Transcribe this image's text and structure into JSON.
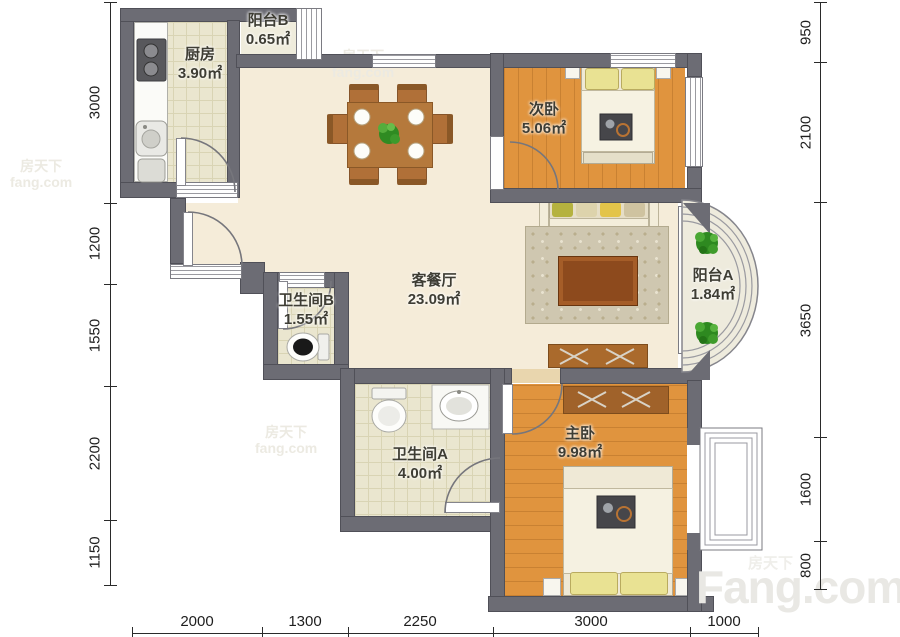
{
  "rooms": [
    {
      "id": "kitchen",
      "name": "厨房",
      "area": "3.90㎡"
    },
    {
      "id": "balcony-b",
      "name": "阳台B",
      "area": "0.65㎡"
    },
    {
      "id": "living-dining",
      "name": "客餐厅",
      "area": "23.09㎡"
    },
    {
      "id": "bedroom-second",
      "name": "次卧",
      "area": "5.06㎡"
    },
    {
      "id": "balcony-a",
      "name": "阳台A",
      "area": "1.84㎡"
    },
    {
      "id": "bathroom-b",
      "name": "卫生间B",
      "area": "1.55㎡"
    },
    {
      "id": "bathroom-a",
      "name": "卫生间A",
      "area": "4.00㎡"
    },
    {
      "id": "bedroom-master",
      "name": "主卧",
      "area": "9.98㎡"
    }
  ],
  "dimensions": {
    "left": [
      "3000",
      "1200",
      "1550",
      "2200",
      "1150"
    ],
    "right": [
      "950",
      "2100",
      "3650",
      "1600",
      "800"
    ],
    "bottom": [
      "2000",
      "1300",
      "2250",
      "3000",
      "1000"
    ]
  },
  "watermark": {
    "brand": "Fang.com",
    "brand_cn": "房天下",
    "site_small": "fang.com"
  }
}
